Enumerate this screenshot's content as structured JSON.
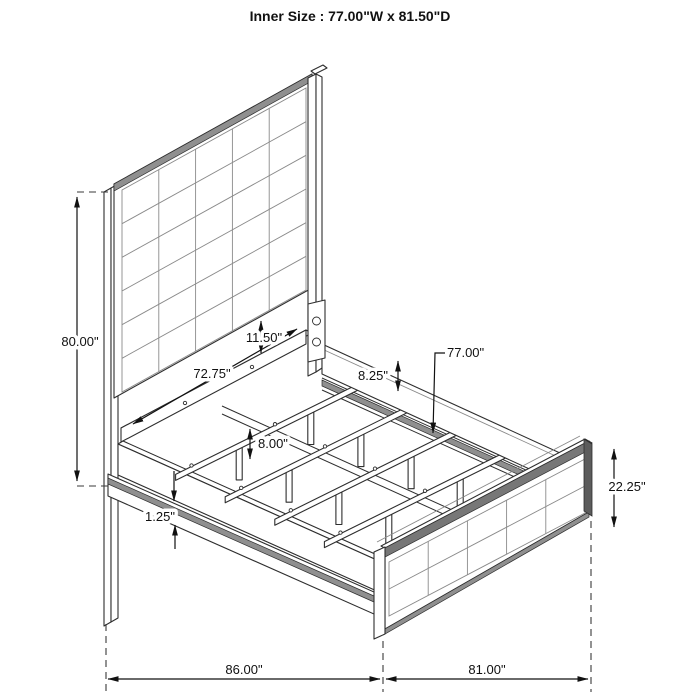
{
  "title": "Inner Size : 77.00\"W x 81.50\"D",
  "drawing": {
    "description": "Isometric dimension line drawing of an upholstered panel bed (tufted headboard and footboard, slat frame)",
    "labels": {
      "headboard_height": "80.00\"",
      "panel_gap": "11.50\"",
      "slat_span": "72.75\"",
      "rail_height": "8.25\"",
      "slat_length": "77.00\"",
      "leg_height": "8.00\"",
      "base_thickness": "1.25\"",
      "footboard_height": "22.25\"",
      "overall_depth": "86.00\"",
      "overall_width": "81.00\""
    }
  }
}
